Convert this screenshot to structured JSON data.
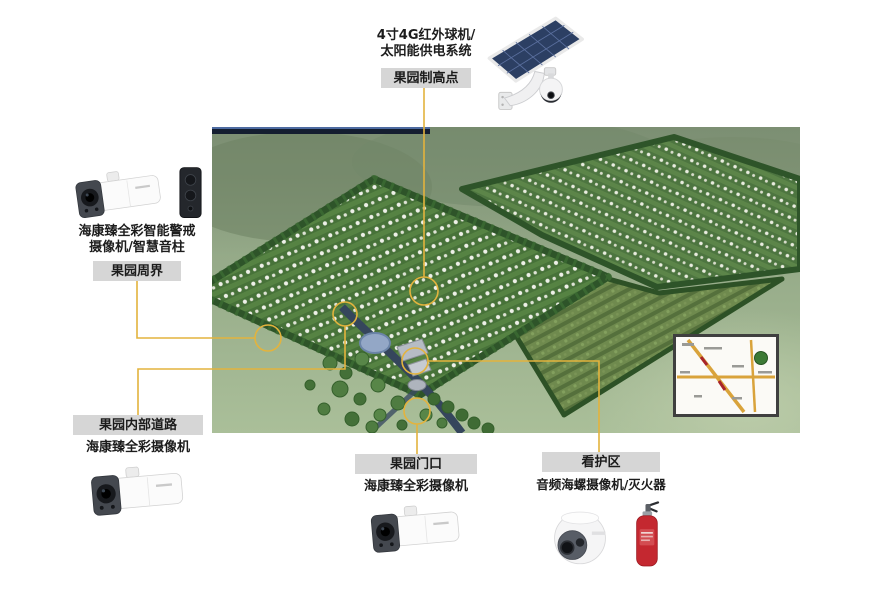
{
  "palette": {
    "connector": "#e3b33d",
    "label_box_bg": "#d6d6d6",
    "text": "#1c1c1c",
    "photo_bar": "#141e30"
  },
  "annotations": {
    "highpoint": {
      "device_line1": "4寸4G红外球机/",
      "device_line2": "太阳能供电系统",
      "zone": "果园制高点"
    },
    "perimeter": {
      "device_line1": "海康臻全彩智能警戒",
      "device_line2": "摄像机/智慧音柱",
      "zone": "果园周界"
    },
    "internal_road": {
      "zone": "果园内部道路",
      "device": "海康臻全彩摄像机"
    },
    "gate": {
      "zone": "果园门口",
      "device": "海康臻全彩摄像机"
    },
    "care_area": {
      "zone": "看护区",
      "device": "音频海螺摄像机/灭火器"
    }
  },
  "icons": {
    "highpoint_device": "solar-panel-4g-ptz-camera",
    "perimeter_devices": [
      "bullet-camera",
      "smart-audio-column"
    ],
    "internal_road_device": "bullet-camera",
    "gate_device": "bullet-camera",
    "care_area_devices": [
      "turret-camera",
      "fire-extinguisher"
    ]
  },
  "photo": {
    "description": "orchard-aerial-rendering",
    "inset": "location-map-inset"
  }
}
